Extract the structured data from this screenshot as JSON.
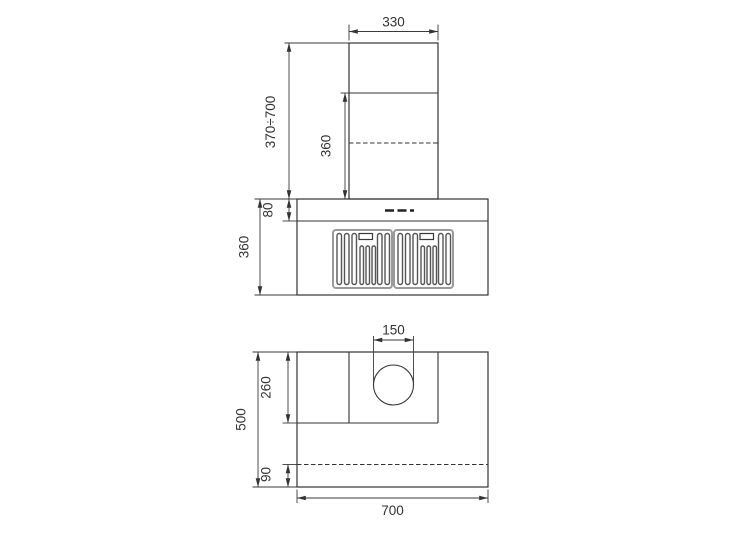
{
  "drawing": {
    "front_view": {
      "label_chimney_width": "330",
      "label_chimney_height_range": "370÷700",
      "label_chimney_visible_section": "360",
      "label_control_panel_height": "80",
      "label_hood_body_height": "360"
    },
    "plan_view": {
      "label_duct_diameter": "150",
      "label_chimney_depth": "260",
      "label_total_depth": "500",
      "label_rear_strip_depth": "90",
      "label_total_width": "700"
    },
    "style": {
      "line_color": "#333333",
      "filter_frame_color": "#9a9a9a",
      "background_color": "#ffffff"
    }
  }
}
